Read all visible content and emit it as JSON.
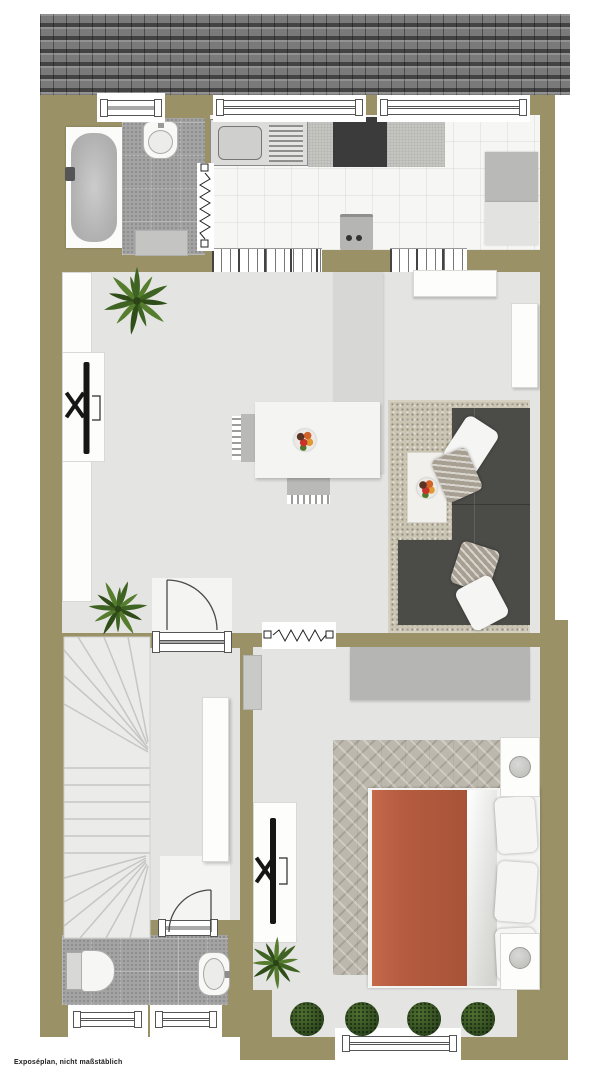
{
  "footer": {
    "disclaimer": "Exposéplan, nicht maßstäblich"
  },
  "palette": {
    "wall": "#9a9266",
    "roof": "#7a7a7a",
    "floor": "#e4e4e3",
    "bath_tile": "#a3a3a3",
    "kitchen_tile": "#f6f6f5",
    "counter": "#c7c7c4",
    "cooktop": "#3b3b3b",
    "sofa": "#4b4b48",
    "bed_blanket": "#b65c40",
    "living_rug": "#cac4b3",
    "bedroom_rug": "#bdb8ad",
    "plant_green": "#3f6322"
  },
  "rooms": [
    "roof",
    "bathroom-top",
    "kitchen",
    "living-room",
    "dining-area",
    "hallway",
    "staircase",
    "bedroom",
    "bathroom-bottom"
  ],
  "objects": [
    "bathtub",
    "wash-basin",
    "kitchen-sink",
    "cooktop",
    "fridge",
    "radiator",
    "tv-lowboard",
    "dining-table",
    "chairs",
    "sectional-sofa",
    "coffee-table",
    "wardrobe",
    "desk",
    "double-bed",
    "nightstand-lamps",
    "toilet",
    "plants",
    "windows",
    "doors"
  ]
}
